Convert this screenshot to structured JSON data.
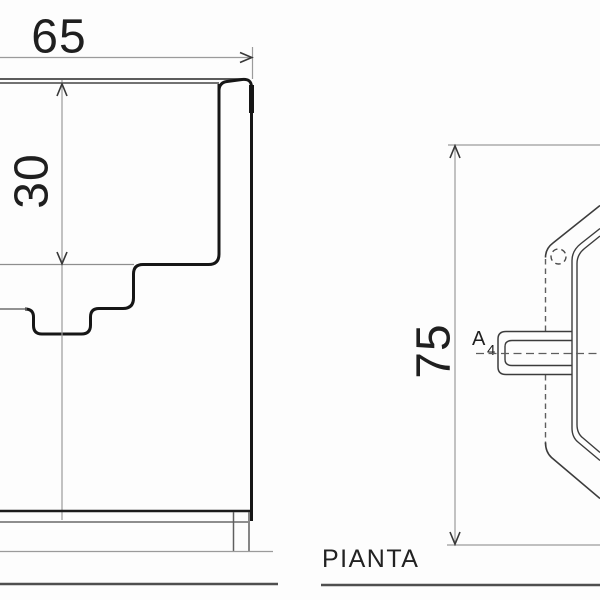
{
  "drawing": {
    "type": "technical-drawing",
    "views": {
      "side_section": {
        "dimensions": [
          {
            "id": "width",
            "value": "65",
            "orientation": "horizontal"
          },
          {
            "id": "depth",
            "value": "30",
            "orientation": "vertical"
          }
        ]
      },
      "plan": {
        "label": "PIANTA",
        "section_ref": {
          "letter": "A",
          "subscript": "4"
        },
        "dimensions": [
          {
            "id": "height",
            "value": "75",
            "orientation": "vertical"
          }
        ]
      }
    },
    "labels": {
      "dim_width": "65",
      "dim_depth": "30",
      "dim_plan_height": "75",
      "view_label": "PIANTA",
      "section_letter": "A",
      "section_subscript": "4"
    },
    "colors": {
      "background": "#fdfdfd",
      "contour": "#161616",
      "plan_outline": "#3c3c3c",
      "rim_line": "#454545",
      "thin_gray": "#8e8e8e",
      "dash_line": "#5e5e5e",
      "arrow": "#383838",
      "text": "#1f1f1f"
    }
  }
}
